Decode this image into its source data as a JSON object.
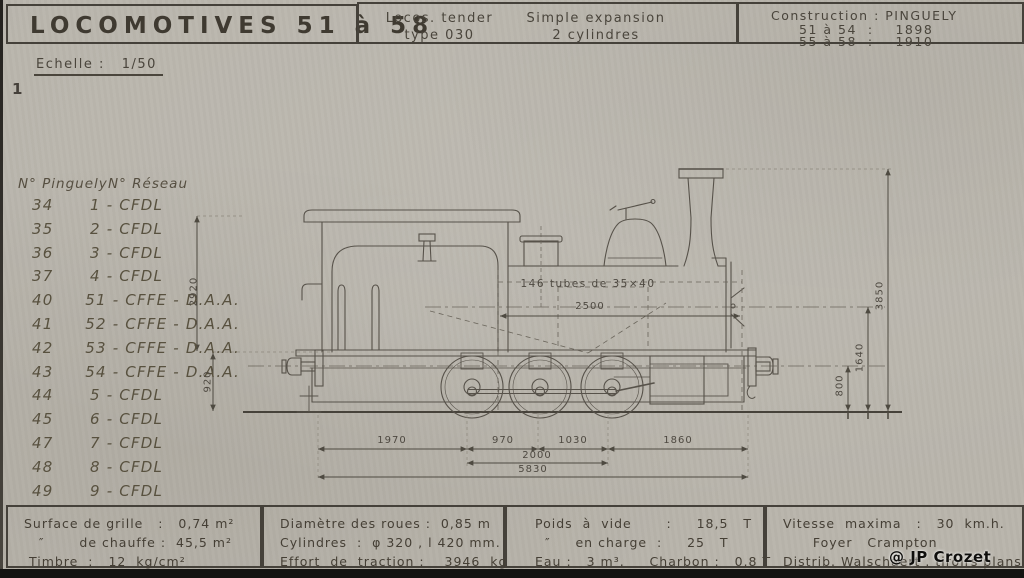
{
  "header": {
    "title": "LOCOMOTIVES  51 à 58",
    "loco_type": {
      "line1": "Locos. tender",
      "line2": "type 030"
    },
    "expansion": {
      "line1": "Simple expansion",
      "line2": "2 cylindres"
    },
    "construction": {
      "title": "Construction : PINGUELY",
      "row1": "51 à 54  :    1898",
      "row2": "55 à 58  :    1910"
    }
  },
  "page": {
    "scale": "Echelle :   1/50",
    "number": "1"
  },
  "roster": {
    "col1": "N° Pinguely",
    "col2": "N° Réseau",
    "rows": [
      {
        "p": "34",
        "r": "1 - CFDL"
      },
      {
        "p": "35",
        "r": "2 - CFDL"
      },
      {
        "p": "36",
        "r": "3 - CFDL"
      },
      {
        "p": "37",
        "r": "4 - CFDL"
      },
      {
        "p": "40",
        "r": "51 - CFFE - D.A.A."
      },
      {
        "p": "41",
        "r": "52 - CFFE - D.A.A."
      },
      {
        "p": "42",
        "r": "53 - CFFE - D.A.A."
      },
      {
        "p": "43",
        "r": "54 - CFFE - D.A.A."
      },
      {
        "p": "44",
        "r": "5 - CFDL"
      },
      {
        "p": "45",
        "r": "6 - CFDL"
      },
      {
        "p": "47",
        "r": "7 - CFDL"
      },
      {
        "p": "48",
        "r": "8 - CFDL"
      },
      {
        "p": "49",
        "r": "9 - CFDL"
      }
    ]
  },
  "drawing": {
    "tubes_label": "146 tubes de 35×40",
    "dims": {
      "boiler_tube_length": "2500",
      "rear_overhang": "1970",
      "axle_spacing_1": "970",
      "axle_spacing_2": "1030",
      "front_overhang": "1860",
      "total_wheelbase": "2000",
      "total_length": "5830",
      "cab_height": "2920",
      "rear_height": "920",
      "buffer_height": "800",
      "boiler_axis_height": "1640",
      "overall_height": "3850"
    }
  },
  "specs": {
    "boiler": [
      "Surface de grille   :   0,74 m²",
      "   ″       de chauffe :  45,5 m²",
      " Timbre  :   12  kg/cm²"
    ],
    "running_gear": [
      "Diamètre des roues :  0,85 m",
      "Cylindres  :  φ 320 , l 420 mm.",
      "Effort  de  traction :    3946  kg"
    ],
    "weights": [
      "Poids  à  vide       :     18,5   T",
      "  ″     en charge  :     25   T",
      "Eau :   3 m³.     Charbon :   0,8 T"
    ],
    "performance": [
      "Vitesse  maxima   :   30  km.h.",
      "      Foyer   Crampton",
      "Distrib. Walschaert . tiroirs plans"
    ]
  },
  "watermark": "@ JP Crozet",
  "colors": {
    "paper": "#b8b4ab",
    "ink": "#4c473e",
    "line": "#5a554b"
  }
}
